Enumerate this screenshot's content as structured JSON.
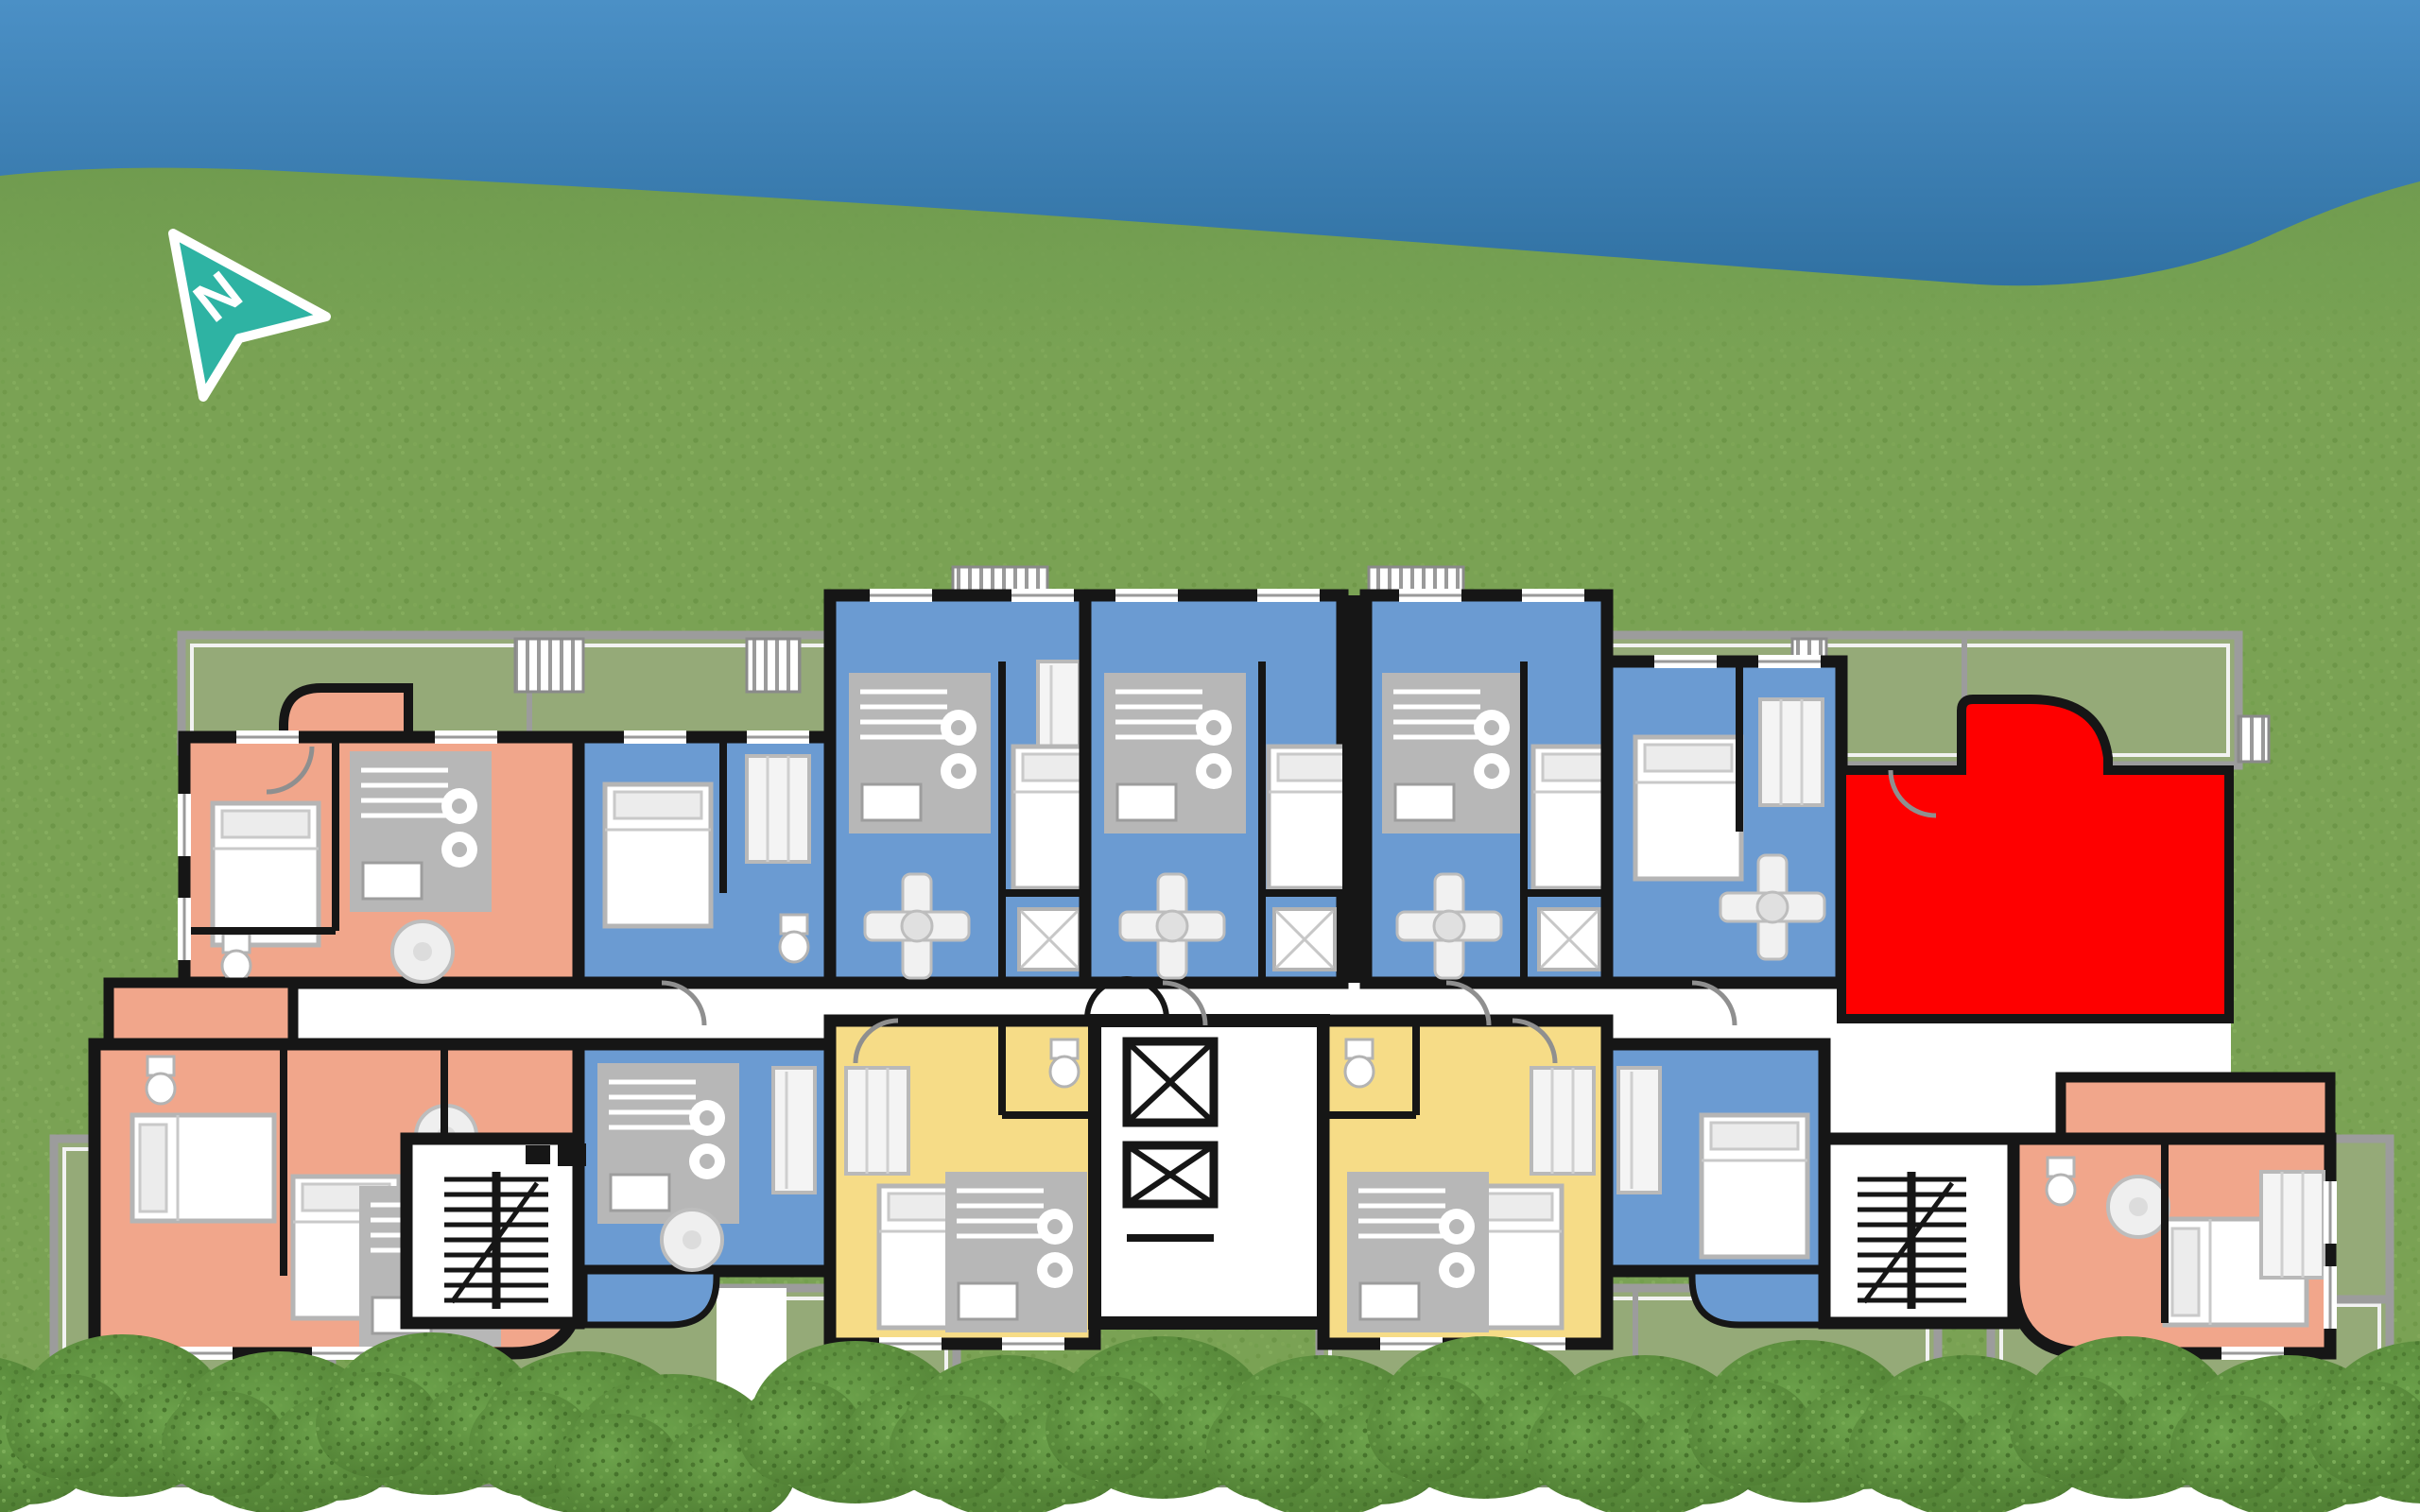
{
  "scene": {
    "description": "Aerial architectural site plan of one apartment-building floor on a lawn; sky band across the top, hedge row along the bottom, one unit highlighted in solid red",
    "compass": {
      "label": "N"
    },
    "palette": {
      "sky-top": "#4b90c6",
      "sky-bottom": "#2e6e9f",
      "grass": "#7aa254",
      "terrace": "#95aa78",
      "terrace-rail": "#9c9c9c",
      "wall": "#161616",
      "corridor-white": "#ffffff",
      "unit-salmon": "#f1a68b",
      "unit-blue": "#6b9bd2",
      "unit-yellow": "#f6dc87",
      "unit-red": "#fe0000",
      "hedge-dark": "#4c7a30",
      "hedge-light": "#6da34c",
      "compass-teal": "#2eb3a3"
    },
    "legend_implicit": {
      "salmon_units": 4,
      "blue_units": 8,
      "yellow_units": 2,
      "red_highlighted_units": 1
    }
  },
  "floorplan": {
    "highlighted_unit": {
      "position": "north-east",
      "color_key": "unit-red",
      "state": "selected"
    },
    "units": [
      {
        "position": "north-west-1",
        "color_key": "unit-salmon",
        "highlighted": false
      },
      {
        "position": "north-west-2",
        "color_key": "unit-blue",
        "highlighted": false
      },
      {
        "position": "north-center-1",
        "color_key": "unit-blue",
        "highlighted": false
      },
      {
        "position": "north-center-2",
        "color_key": "unit-blue",
        "highlighted": false
      },
      {
        "position": "north-center-3",
        "color_key": "unit-blue",
        "highlighted": false
      },
      {
        "position": "north-east-1",
        "color_key": "unit-blue",
        "highlighted": false
      },
      {
        "position": "north-east-2",
        "color_key": "unit-red",
        "highlighted": true
      },
      {
        "position": "south-west-1",
        "color_key": "unit-salmon",
        "highlighted": false
      },
      {
        "position": "south-west-2",
        "color_key": "unit-blue",
        "highlighted": false
      },
      {
        "position": "south-center-1",
        "color_key": "unit-yellow",
        "highlighted": false
      },
      {
        "position": "south-center-2",
        "color_key": "unit-yellow",
        "highlighted": false
      },
      {
        "position": "south-east-1",
        "color_key": "unit-blue",
        "highlighted": false
      },
      {
        "position": "south-east-2",
        "color_key": "unit-salmon",
        "highlighted": false
      }
    ],
    "core": {
      "elevator_shafts": 2,
      "staircases": 2,
      "main_entrance_double_door": true
    }
  },
  "landscaping": {
    "railed_terraces": 6,
    "hedge_bushes": 16,
    "hedge_gap_walkway": true,
    "balcony_grilles": 8
  }
}
